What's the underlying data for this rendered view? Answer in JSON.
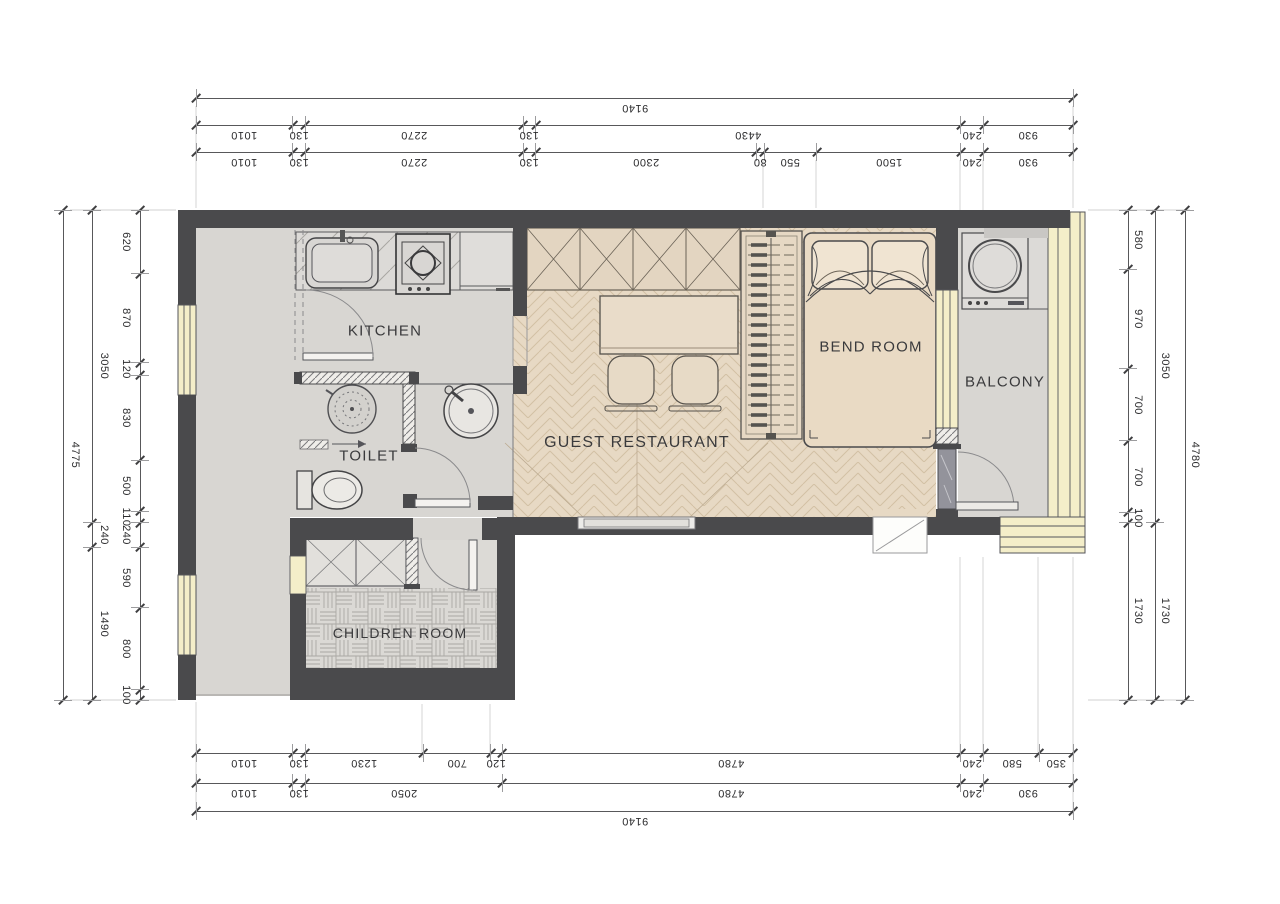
{
  "drawing": {
    "type": "apartment floor plan"
  },
  "rooms": {
    "kitchen": {
      "label": "KITCHEN"
    },
    "toilet": {
      "label": "TOILET"
    },
    "guest_restaurant": {
      "label": "GUEST RESTAURANT"
    },
    "bend_room": {
      "label": "BEND ROOM"
    },
    "balcony": {
      "label": "BALCONY"
    },
    "children_room": {
      "label": "CHILDREN ROOM"
    }
  },
  "dimensions": {
    "top": {
      "rows": [
        [
          "9140"
        ],
        [
          "1010",
          "130",
          "2270",
          "130",
          "4430",
          "240",
          "930"
        ],
        [
          "1010",
          "130",
          "2270",
          "130",
          "2300",
          "80",
          "550",
          "1500",
          "240",
          "930"
        ]
      ]
    },
    "bottom": {
      "rows": [
        [
          "1010",
          "130",
          "1230",
          "700",
          "120",
          "4780",
          "240",
          "580",
          "350"
        ],
        [
          "1010",
          "130",
          "2050",
          "4780",
          "240",
          "930"
        ],
        [
          "9140"
        ]
      ]
    },
    "left": {
      "rows": [
        [
          "4775"
        ],
        [
          "3050",
          "240",
          "1490"
        ],
        [
          "620",
          "870",
          "120",
          "830",
          "500",
          "110",
          "240",
          "590",
          "800",
          "100"
        ]
      ]
    },
    "right": {
      "rows": [
        [
          "580",
          "970",
          "700",
          "700",
          "100",
          "1730"
        ],
        [
          "3050",
          "1730"
        ],
        [
          "4780"
        ]
      ]
    }
  },
  "colors": {
    "wall": "#4a4a4c",
    "window_frame": "#f4eec9",
    "floor_gray": "#d8d6d2",
    "floor_wood": "#e7d9c4",
    "floor_children": "#dbd9d5",
    "dimension_text": "#2c2c2e",
    "page_background": "#ffffff"
  },
  "icons": [
    "sink-icon",
    "stove-icon",
    "washing-machine-icon",
    "shower-icon",
    "toilet-icon",
    "basin-icon",
    "bed-icon",
    "wardrobe-hangers-icon",
    "stool-icon",
    "door-swing-icon"
  ]
}
